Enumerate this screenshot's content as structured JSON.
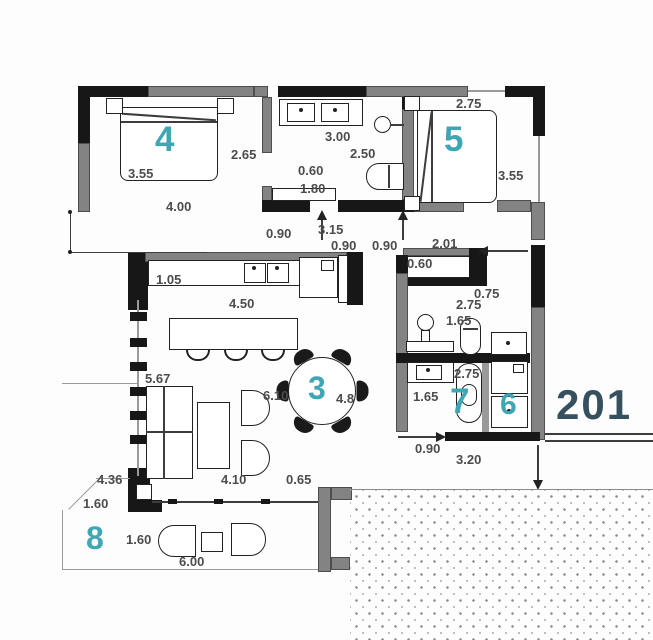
{
  "apartment": {
    "number": "201"
  },
  "rooms": {
    "r3": "3",
    "r4": "4",
    "r5": "5",
    "r6": "6",
    "r7": "7",
    "r8": "8"
  },
  "dims": {
    "room4_bed_width": "3.55",
    "room4_width": "4.00",
    "room4_depth": "2.65",
    "bath_width": "3.00",
    "bath_inner": "2.50",
    "bath_shower_depth": "0.60",
    "bath_shower_width": "1.80",
    "room5_width": "2.75",
    "room5_depth": "3.55",
    "hall_door_left": "0.90",
    "hall_width": "3.15",
    "hall_door_mid": "0.90",
    "hall_door_right": "0.90",
    "hall_room5": "2.01",
    "wardrobe_depth": "0.60",
    "wc_width_top": "0.75",
    "wc_length": "2.75",
    "wc_width": "1.65",
    "kitchen_counter_depth": "1.05",
    "kitchen_width": "4.50",
    "living_length": "5.67",
    "living_width": "6.10",
    "living_width_b": "4.8",
    "sofa_zone_width": "4.10",
    "living_gap": "0.65",
    "room7_length": "2.75",
    "room7_width": "1.65",
    "room7_door": "0.90",
    "bottom_width": "3.20",
    "terrace_depth": "4.36",
    "terrace_cut_a": "1.60",
    "terrace_cut_b": "1.60",
    "terrace_width": "6.00"
  },
  "colors": {
    "room_number": "#3fa6b3",
    "apartment_number": "#36515d",
    "wall_dark": "#171717",
    "wall_gray": "#838383",
    "dimension_text": "#4c4c4c",
    "stipple_dot": "#878d92"
  },
  "symbols": [
    "double-bed",
    "nightstand",
    "vanity-double-sink",
    "toilet",
    "bathtub",
    "kitchen-sink",
    "fridge",
    "kitchen-island",
    "bar-stool",
    "dining-table",
    "dining-chair",
    "sofa",
    "coffee-table",
    "armchair",
    "washbasin",
    "washing-machine",
    "terrace-chair",
    "terrace-table"
  ]
}
